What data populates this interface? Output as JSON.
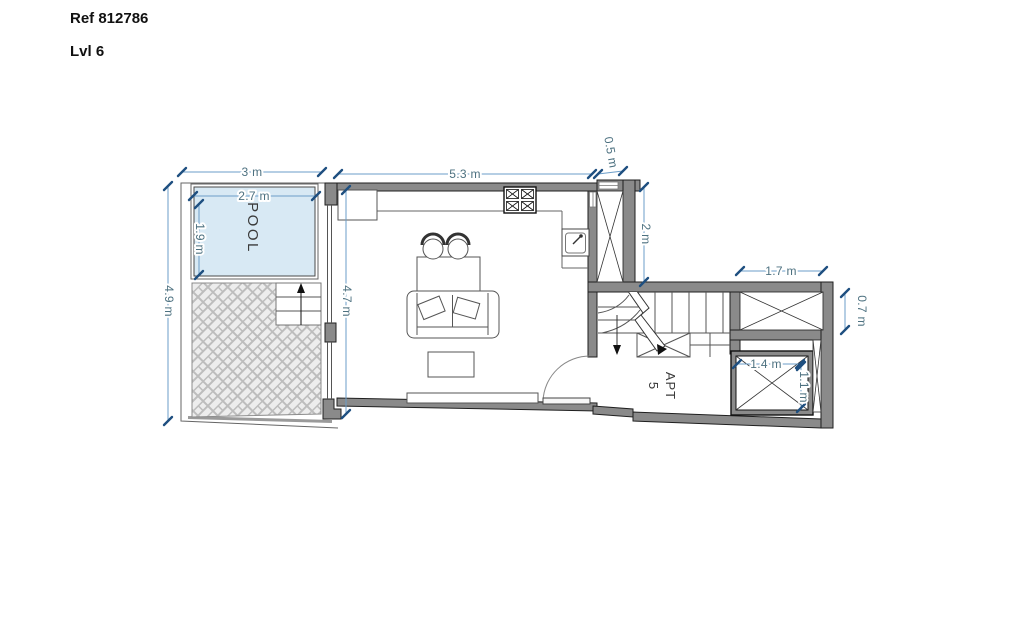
{
  "header": {
    "ref": "Ref 812786",
    "level": "Lvl 6"
  },
  "rooms": {
    "pool": "POOL",
    "apartment": {
      "line1": "APT",
      "line2": "5"
    }
  },
  "dimensions": {
    "terrace_width": "3 m",
    "pool_width": "2.7 m",
    "pool_length": "1.9 m",
    "terrace_length": "4.9 m",
    "living_width": "5.3 m",
    "duct_width": "0.5 m",
    "duct_length": "2 m",
    "living_length": "4.7 m",
    "landing_width": "1.7 m",
    "landing_depth": "0.7 m",
    "lift_width": "1.4 m",
    "lift_depth": "1.1 m"
  },
  "colors": {
    "dimension_line": "#6b9dc8",
    "dimension_tick": "#1e4f80",
    "dimension_text": "#4d7180",
    "wall_fill": "#8a8a8a",
    "wall_outline": "#1f1f1f",
    "pool_fill": "#d8e9f4",
    "paving_line": "#bdbdbd",
    "paving_bg": "#ededed",
    "header_text": "#111111"
  }
}
